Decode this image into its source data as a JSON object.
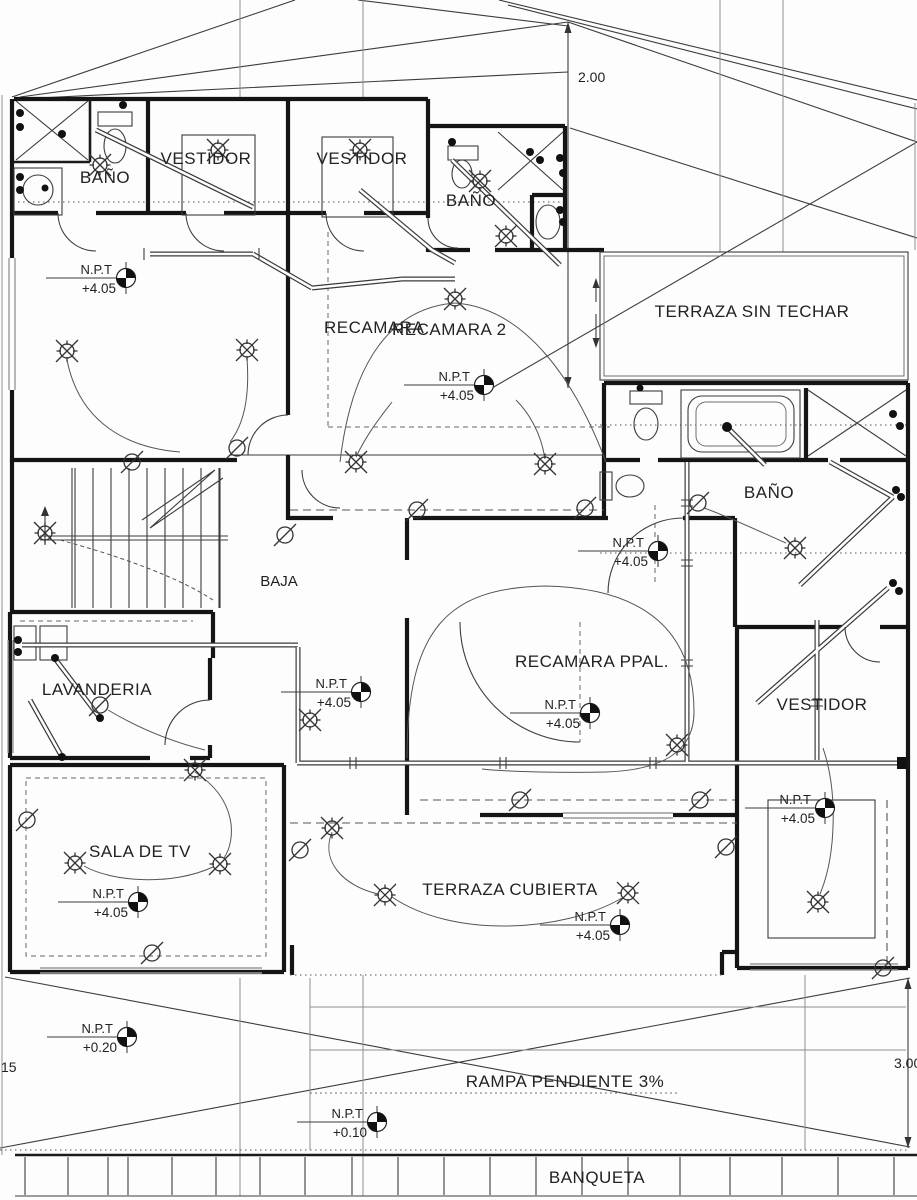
{
  "drawing": {
    "type": "architectural-electrical-floor-plan",
    "colors": {
      "paper": "#fdfdfd",
      "ink": "#151515",
      "thin_line": "#3c3c3c",
      "gray_line": "#9a9a9a"
    },
    "rooms": {
      "bano_top_left": "BAÑO",
      "vestidor_1": "VESTIDOR",
      "vestidor_2": "VESTIDOR",
      "bano_top_mid": "BAÑO",
      "terraza_sin_techar": "TERRAZA SIN TECHAR",
      "recamara": "RECAMARA",
      "recamara_2": "RECAMARA 2",
      "bano_right": "BAÑO",
      "baja": "BAJA",
      "lavanderia": "LAVANDERIA",
      "recamara_ppal": "RECAMARA PPAL.",
      "vestidor_right": "VESTIDOR",
      "sala_de_tv": "SALA DE TV",
      "terraza_cubierta": "TERRAZA CUBIERTA",
      "rampa": "RAMPA PENDIENTE 3%",
      "banqueta": "BANQUETA"
    },
    "npt_label": "N.P.T",
    "npt_markers": [
      {
        "id": "bano-top-left",
        "value": "+4.05"
      },
      {
        "id": "recamara-2",
        "value": "+4.05"
      },
      {
        "id": "bano-right",
        "value": "+4.05"
      },
      {
        "id": "hall-center",
        "value": "+4.05"
      },
      {
        "id": "recamara-ppal",
        "value": "+4.05"
      },
      {
        "id": "vestidor-right",
        "value": "+4.05"
      },
      {
        "id": "sala-de-tv",
        "value": "+4.05"
      },
      {
        "id": "terraza-cubierta",
        "value": "+4.05"
      },
      {
        "id": "patio",
        "value": "+0.20"
      },
      {
        "id": "rampa",
        "value": "+0.10"
      }
    ],
    "dimensions": {
      "top": "2.00",
      "right": "3.00",
      "left_partial": "15"
    }
  }
}
